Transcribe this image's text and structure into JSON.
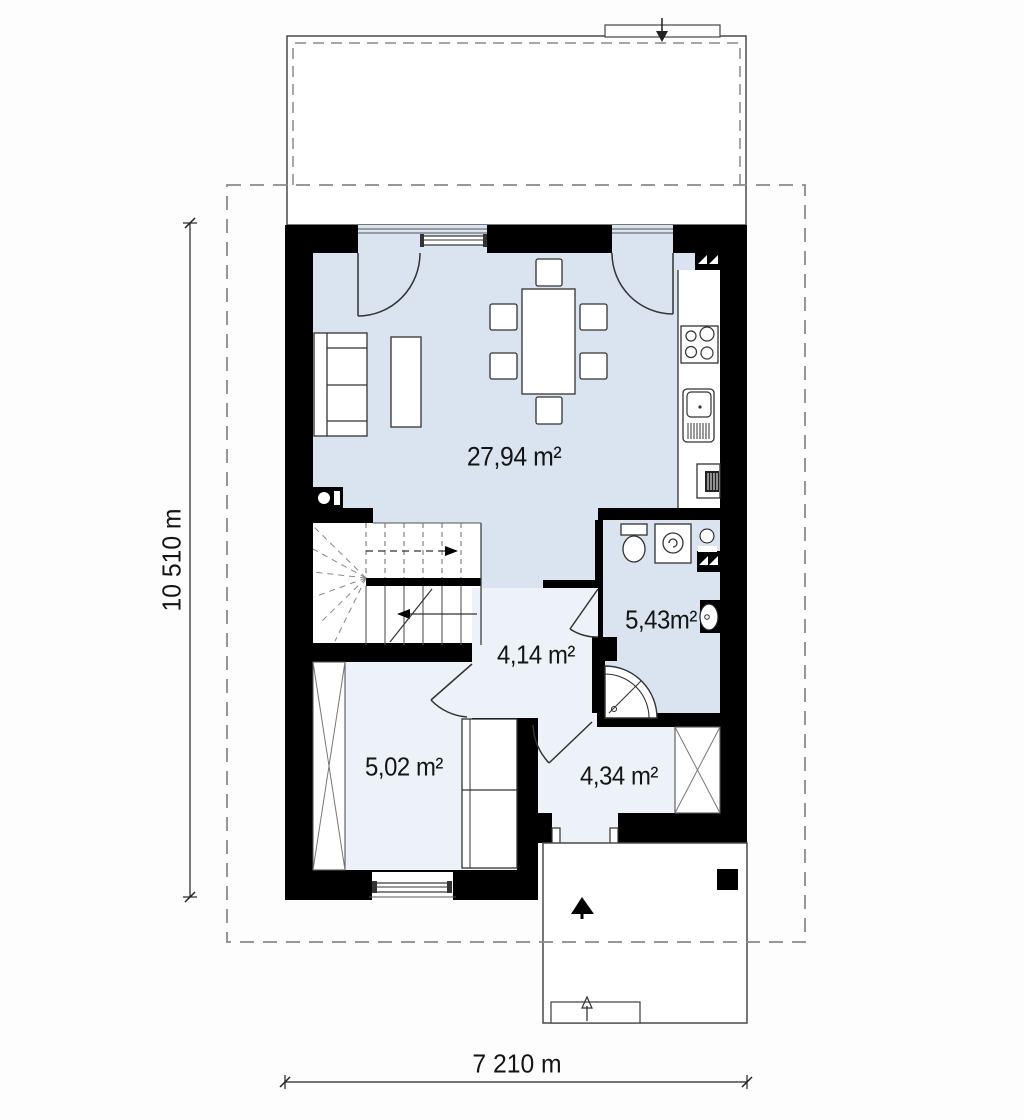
{
  "plan": {
    "rooms": {
      "living_kitchen": {
        "area_label": "27,94 m²"
      },
      "hallway": {
        "area_label": "4,14 m²"
      },
      "bathroom": {
        "area_label": "5,43m²"
      },
      "storage": {
        "area_label": "5,02 m²"
      },
      "entry": {
        "area_label": "4,34 m²"
      }
    },
    "dimensions": {
      "overall_width": "7 210 m",
      "overall_height": "10 510 m"
    },
    "fixtures": [
      "sofa",
      "coffee-table",
      "dining-table",
      "dining-chairs",
      "kitchen-stove",
      "kitchen-sink",
      "kitchen-oven",
      "ventilation-shaft",
      "toilet",
      "washing-machine",
      "boiler",
      "wash-basin",
      "shower",
      "staircase",
      "wardrobe",
      "shelf-cabinet",
      "entrance-door",
      "terrace-doors",
      "windows",
      "porch-step",
      "porch-column",
      "entrance-arrow"
    ],
    "colors": {
      "room_fill": "#d9e4f0",
      "hall_fill": "#ecf2f8",
      "wall": "#000000",
      "line": "#333333",
      "dash": "#8a8a8a",
      "outline": "#4a4a4a"
    }
  }
}
